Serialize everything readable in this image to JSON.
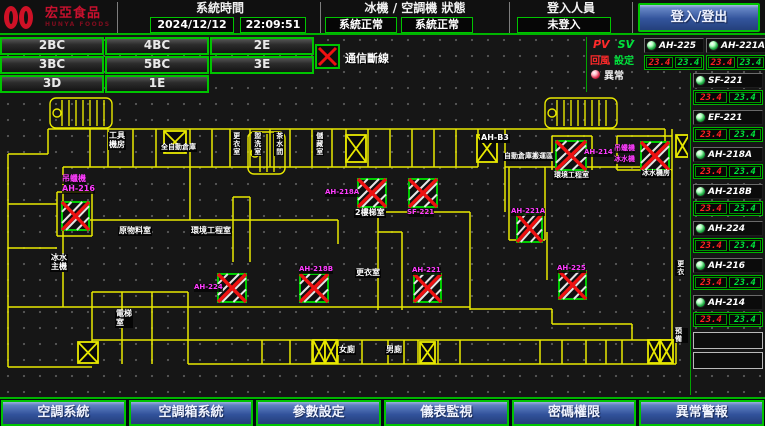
{
  "colors": {
    "accent_green": "#00c400",
    "alarm_red": "#ee1111",
    "magenta": "#ff3cff",
    "wall_yellow": "#e8e800",
    "button_blue": "#31519a"
  },
  "header": {
    "brand": "宏亞食品",
    "brand_sub": "HUNYA FOODS",
    "system_time_label": "系統時間",
    "date": "2024/12/12",
    "time": "22:09:51",
    "chiller_status_label": "冰機 / 空調機 狀態",
    "chiller_status": "系統正常",
    "ac_status": "系統正常",
    "login_label": "登入人員",
    "login_status": "未登入",
    "login_button": "登入/登出"
  },
  "floor_buttons": [
    "2BC",
    "4BC",
    "2E",
    "3BC",
    "5BC",
    "3E",
    "3D",
    "1E",
    ""
  ],
  "comm_legend": {
    "label": "通信斷線"
  },
  "panel": {
    "pv_label": "PV",
    "sv_label": "SV",
    "pv_legend": "回風",
    "sv_legend": "設定",
    "alarm_label": "異常",
    "top_units": [
      {
        "name": "AH-225",
        "pv": "23.4",
        "sv": "23.4"
      },
      {
        "name": "AH-221A",
        "pv": "23.4",
        "sv": "23.4"
      }
    ],
    "column_units": [
      {
        "name": "SF-221",
        "pv": "23.4",
        "sv": "23.4"
      },
      {
        "name": "EF-221",
        "pv": "23.4",
        "sv": "23.4"
      },
      {
        "name": "AH-218A",
        "pv": "23.4",
        "sv": "23.4"
      },
      {
        "name": "AH-218B",
        "pv": "23.4",
        "sv": "23.4"
      },
      {
        "name": "AH-224",
        "pv": "23.4",
        "sv": "23.4"
      },
      {
        "name": "AH-216",
        "pv": "23.4",
        "sv": "23.4"
      },
      {
        "name": "AH-214",
        "pv": "23.4",
        "sv": "23.4"
      }
    ],
    "empty_slots": 2
  },
  "bottom_buttons": [
    "空調系統",
    "空調箱系統",
    "參數設定",
    "儀表監視",
    "密碼權限",
    "異常警報"
  ],
  "plan": {
    "comm_fail_boxes": [
      {
        "x": 62,
        "y": 110,
        "w": 27,
        "h": 28
      },
      {
        "x": 218,
        "y": 182,
        "w": 28,
        "h": 28
      },
      {
        "x": 300,
        "y": 182,
        "w": 28,
        "h": 28
      },
      {
        "x": 358,
        "y": 87,
        "w": 28,
        "h": 28
      },
      {
        "x": 409,
        "y": 87,
        "w": 28,
        "h": 28
      },
      {
        "x": 414,
        "y": 182,
        "w": 27,
        "h": 28
      },
      {
        "x": 556,
        "y": 49,
        "w": 30,
        "h": 29
      },
      {
        "x": 641,
        "y": 50,
        "w": 28,
        "h": 28
      },
      {
        "x": 517,
        "y": 122,
        "w": 25,
        "h": 28
      },
      {
        "x": 559,
        "y": 179,
        "w": 27,
        "h": 28
      }
    ],
    "hatch_boxes": [
      {
        "x": 164,
        "y": 39,
        "w": 22,
        "h": 22
      },
      {
        "x": 346,
        "y": 43,
        "w": 20,
        "h": 27
      },
      {
        "x": 477,
        "y": 43,
        "w": 20,
        "h": 27
      },
      {
        "x": 676,
        "y": 43,
        "w": 13,
        "h": 22
      },
      {
        "x": 313,
        "y": 248,
        "w": 12,
        "h": 23
      },
      {
        "x": 325,
        "y": 248,
        "w": 12,
        "h": 23
      },
      {
        "x": 420,
        "y": 250,
        "w": 15,
        "h": 21
      },
      {
        "x": 648,
        "y": 248,
        "w": 12,
        "h": 23
      },
      {
        "x": 660,
        "y": 248,
        "w": 13,
        "h": 23
      },
      {
        "x": 78,
        "y": 250,
        "w": 20,
        "h": 21
      }
    ],
    "stairs": [
      {
        "x": 50,
        "y": 6,
        "w": 62,
        "h": 30
      },
      {
        "x": 545,
        "y": 6,
        "w": 72,
        "h": 30
      },
      {
        "x": 248,
        "y": 40,
        "w": 37,
        "h": 42
      }
    ],
    "labels": [
      {
        "text": "工具\n機房",
        "x": 108,
        "y": 40,
        "c": "w"
      },
      {
        "text": "全自動倉庫",
        "x": 160,
        "y": 52,
        "c": "w",
        "s": 7
      },
      {
        "text": "更衣室",
        "x": 231,
        "y": 40,
        "c": "w",
        "v": true,
        "s": 7
      },
      {
        "text": "盥洗室",
        "x": 252,
        "y": 40,
        "c": "w",
        "v": true,
        "s": 7
      },
      {
        "text": "茶水間",
        "x": 274,
        "y": 40,
        "c": "w",
        "v": true,
        "s": 7
      },
      {
        "text": "儲藏室",
        "x": 314,
        "y": 40,
        "c": "w",
        "v": true,
        "s": 7
      },
      {
        "text": "AH-B3",
        "x": 480,
        "y": 42,
        "c": "w"
      },
      {
        "text": "自動倉庫搬運區",
        "x": 503,
        "y": 61,
        "c": "w",
        "s": 7
      },
      {
        "text": "環境工程室",
        "x": 553,
        "y": 80,
        "c": "w",
        "s": 7
      },
      {
        "text": "冰水機房",
        "x": 641,
        "y": 78,
        "c": "w",
        "s": 7
      },
      {
        "text": "2樓梯室",
        "x": 354,
        "y": 117,
        "c": "w"
      },
      {
        "text": "原物料室",
        "x": 118,
        "y": 135,
        "c": "w"
      },
      {
        "text": "環境工程室",
        "x": 190,
        "y": 135,
        "c": "w"
      },
      {
        "text": "冰水\n主機",
        "x": 50,
        "y": 162,
        "c": "w"
      },
      {
        "text": "更衣室",
        "x": 355,
        "y": 177,
        "c": "w"
      },
      {
        "text": "電梯\n室",
        "x": 115,
        "y": 218,
        "c": "w"
      },
      {
        "text": "女廁",
        "x": 338,
        "y": 254,
        "c": "w"
      },
      {
        "text": "男廁",
        "x": 385,
        "y": 254,
        "c": "w"
      },
      {
        "text": "更衣",
        "x": 675,
        "y": 168,
        "c": "w",
        "v": true,
        "s": 7
      },
      {
        "text": "預備",
        "x": 674,
        "y": 236,
        "c": "w",
        "s": 7
      },
      {
        "text": "吊蠟機",
        "x": 62,
        "y": 83,
        "c": "m"
      },
      {
        "text": "AH-216",
        "x": 62,
        "y": 93,
        "c": "m"
      },
      {
        "text": "AH-224",
        "x": 194,
        "y": 192,
        "c": "m",
        "s": 7
      },
      {
        "text": "AH-218B",
        "x": 299,
        "y": 174,
        "c": "m",
        "s": 7
      },
      {
        "text": "AH-218A",
        "x": 325,
        "y": 97,
        "c": "m",
        "s": 7
      },
      {
        "text": "SF-221",
        "x": 407,
        "y": 117,
        "c": "m",
        "s": 7
      },
      {
        "text": "AH-221",
        "x": 412,
        "y": 175,
        "c": "m",
        "s": 7
      },
      {
        "text": "AH-214",
        "x": 584,
        "y": 57,
        "c": "m",
        "s": 7
      },
      {
        "text": "吊蠟機",
        "x": 614,
        "y": 53,
        "c": "m",
        "s": 7
      },
      {
        "text": "冰水機",
        "x": 614,
        "y": 64,
        "c": "m",
        "s": 7
      },
      {
        "text": "AH-221A",
        "x": 511,
        "y": 116,
        "c": "m",
        "s": 7
      },
      {
        "text": "AH-225",
        "x": 557,
        "y": 173,
        "c": "m",
        "s": 7
      }
    ]
  }
}
